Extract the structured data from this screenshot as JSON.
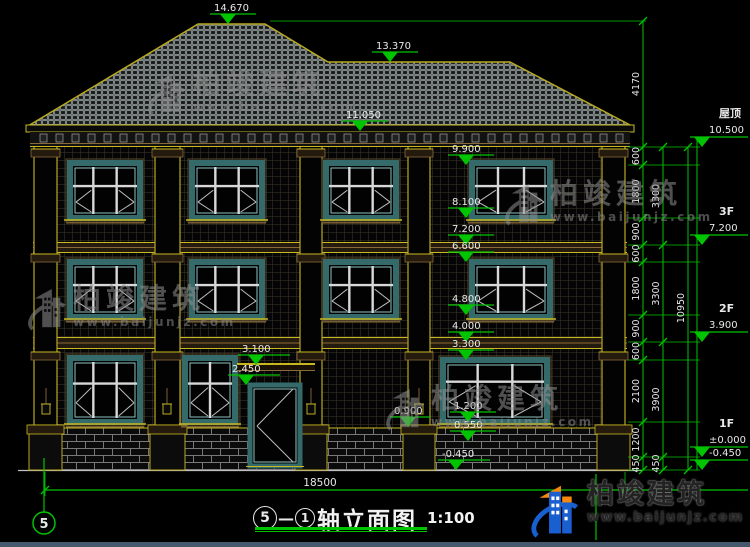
{
  "colors": {
    "background": "#000000",
    "dim_green": "#00c400",
    "text_white": "#e8e8e8",
    "outline_yellow": "#c8b820",
    "molding_brown": "#8a6a3a",
    "window_teal": "#356a6a",
    "mullion_white": "#d8d8d8",
    "watermark_gray": "#8f8f8f",
    "logo_blue": "#1a5fd0",
    "logo_orange": "#f5870f"
  },
  "elevation_markers": {
    "roof": [
      "14.670",
      "13.370",
      "11.050"
    ],
    "mid": [
      "9.900",
      "8.100",
      "7.200",
      "6.600",
      "4.800",
      "4.000",
      "3.300"
    ],
    "door": [
      "3.100",
      "2.450"
    ],
    "base": [
      "0.900",
      "1.200",
      "0.550",
      "-0.450"
    ]
  },
  "right_levels": [
    {
      "label": "屋顶",
      "elevation": "10.500"
    },
    {
      "label": "3F",
      "elevation": "7.200"
    },
    {
      "label": "2F",
      "elevation": "3.900"
    },
    {
      "label": "1F",
      "elevation": "±0.000"
    },
    {
      "label": "",
      "elevation": "-0.450"
    }
  ],
  "dimensions": {
    "chain_inner": [
      "4170",
      "600",
      "1800",
      "900",
      "600",
      "1800",
      "900",
      "600",
      "2100",
      "1200",
      "450"
    ],
    "chain_mid": [
      "3300",
      "3300",
      "3900",
      "450"
    ],
    "chain_outer": [
      "10950"
    ],
    "total_width": "18500"
  },
  "axis": {
    "bottom_left_bubble": "5"
  },
  "title_bar": {
    "bubble_a": "5",
    "separator": "—",
    "bubble_b": "1",
    "title": "轴立面图",
    "scale": "1:100"
  },
  "watermark": {
    "name": "柏竣建筑",
    "url": "www.baijunjz.com"
  },
  "brand_logo": {
    "name": "柏竣建筑",
    "url": "www.baijunjz.com"
  }
}
